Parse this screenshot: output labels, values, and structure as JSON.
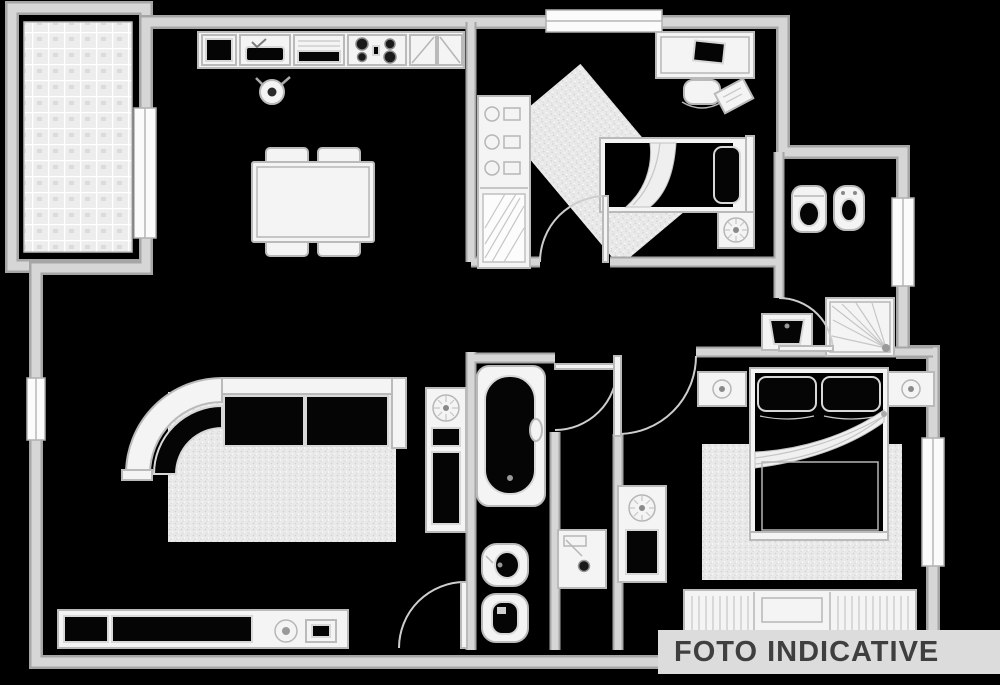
{
  "watermark": {
    "text": "FOTO INDICATIVE"
  },
  "colors": {
    "background": "#000000",
    "wall_fill": "#d6d6d6",
    "wall_edge": "#a6a6a6",
    "fixture_fill": "#f4f4f4",
    "fixture_stroke": "#bababa",
    "dark_fill": "#050505",
    "rug_base": "#e9e9e9",
    "tile_base": "#ededed",
    "banner_bg": "#dcdcdc",
    "banner_text": "#3f3f3f"
  },
  "floorplan": {
    "type": "apartment-floor-plan",
    "rooms": [
      "terrace",
      "kitchen-living-room",
      "bedroom-1",
      "bathroom-1",
      "hallway",
      "bathroom-2",
      "bedroom-2"
    ],
    "fixture_icons": [
      "kitchen-sink-icon",
      "stove-icon",
      "dining-table",
      "corner-sofa",
      "rug",
      "sideboard",
      "wardrobe",
      "single-bed",
      "desk",
      "desk-chair",
      "toilet-icon",
      "bidet-icon",
      "shower-icon",
      "washbasin-icon",
      "bathtub-icon",
      "washing-machine-icon",
      "double-bed",
      "nightstand",
      "plant-icon",
      "door-arc",
      "window"
    ]
  }
}
